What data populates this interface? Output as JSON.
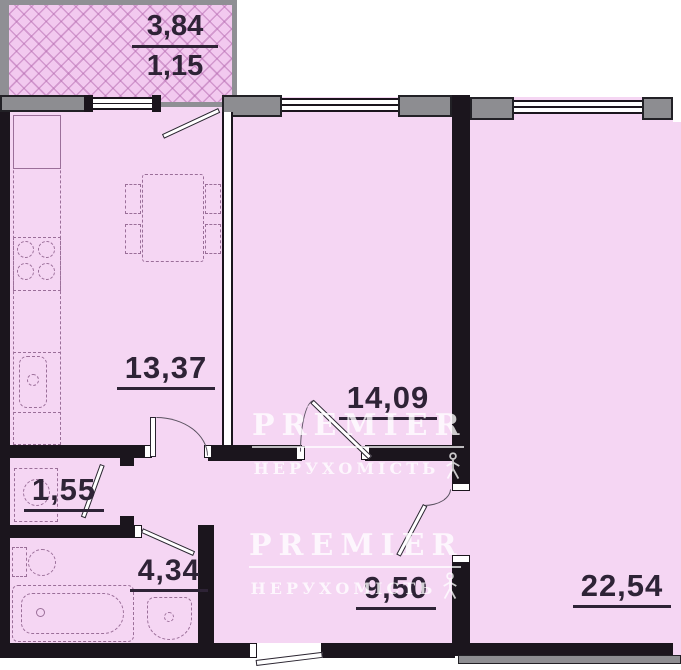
{
  "plan_type": "apartment-floor-plan",
  "areas": {
    "balcony": {
      "numerator": "3,84",
      "denominator": "1,15"
    },
    "kitchen": "13,37",
    "room_middle": "14,09",
    "room_right": "22,54",
    "wc": "1,55",
    "bathroom": "4,34",
    "hallway": "9,50"
  },
  "watermark": {
    "brand": "PREMIER",
    "subtitle": "НЕРУХОМІСТЬ"
  },
  "colors": {
    "room_fill": "#f5d6f3",
    "balcony_fill": "#f2c9ef",
    "wall_dark": "#1b151d",
    "pier_gray": "#8d8d91",
    "label_text": "#2e2336",
    "fixture_line": "#9b6f99",
    "watermark": "#ffffff"
  }
}
